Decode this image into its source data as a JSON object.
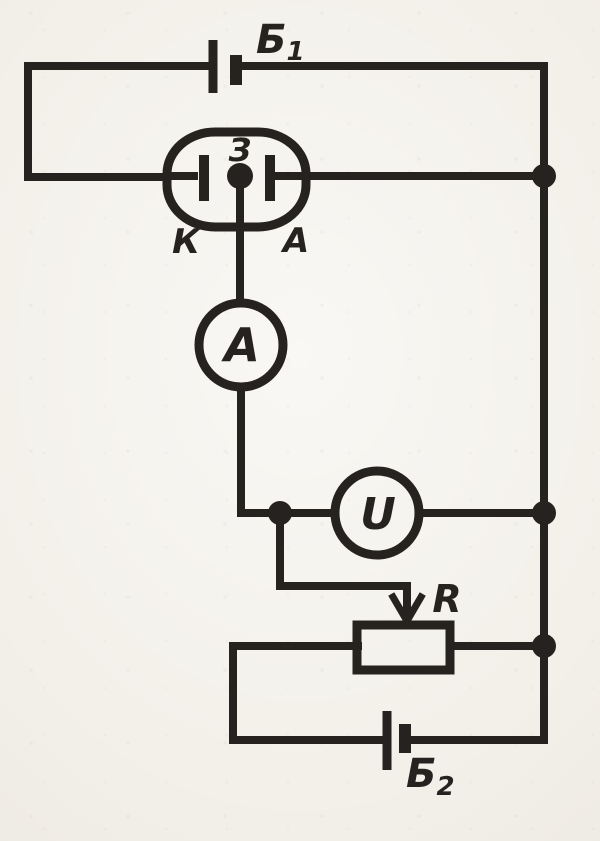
{
  "figure": {
    "type": "circuit-schematic",
    "description": "Scanned textbook circuit diagram: battery B1 feeds a tube (cathode K, anode A, grid electrode Z); grid branch passes through ammeter A; voltmeter U is connected across to the right rail; a potentiometer R with sliding-contact arrow is fed from battery B2 in the bottom loop",
    "ink_color": "#262220",
    "paper_color": "#f2efe8"
  },
  "labels": {
    "battery1": {
      "base": "Б",
      "sub": "1"
    },
    "battery2": {
      "base": "Б",
      "sub": "2"
    },
    "tube": {
      "grid": "З",
      "cathode": "К",
      "anode": "А"
    },
    "ammeter": "A",
    "voltmeter": "U",
    "rheostat": "R"
  }
}
